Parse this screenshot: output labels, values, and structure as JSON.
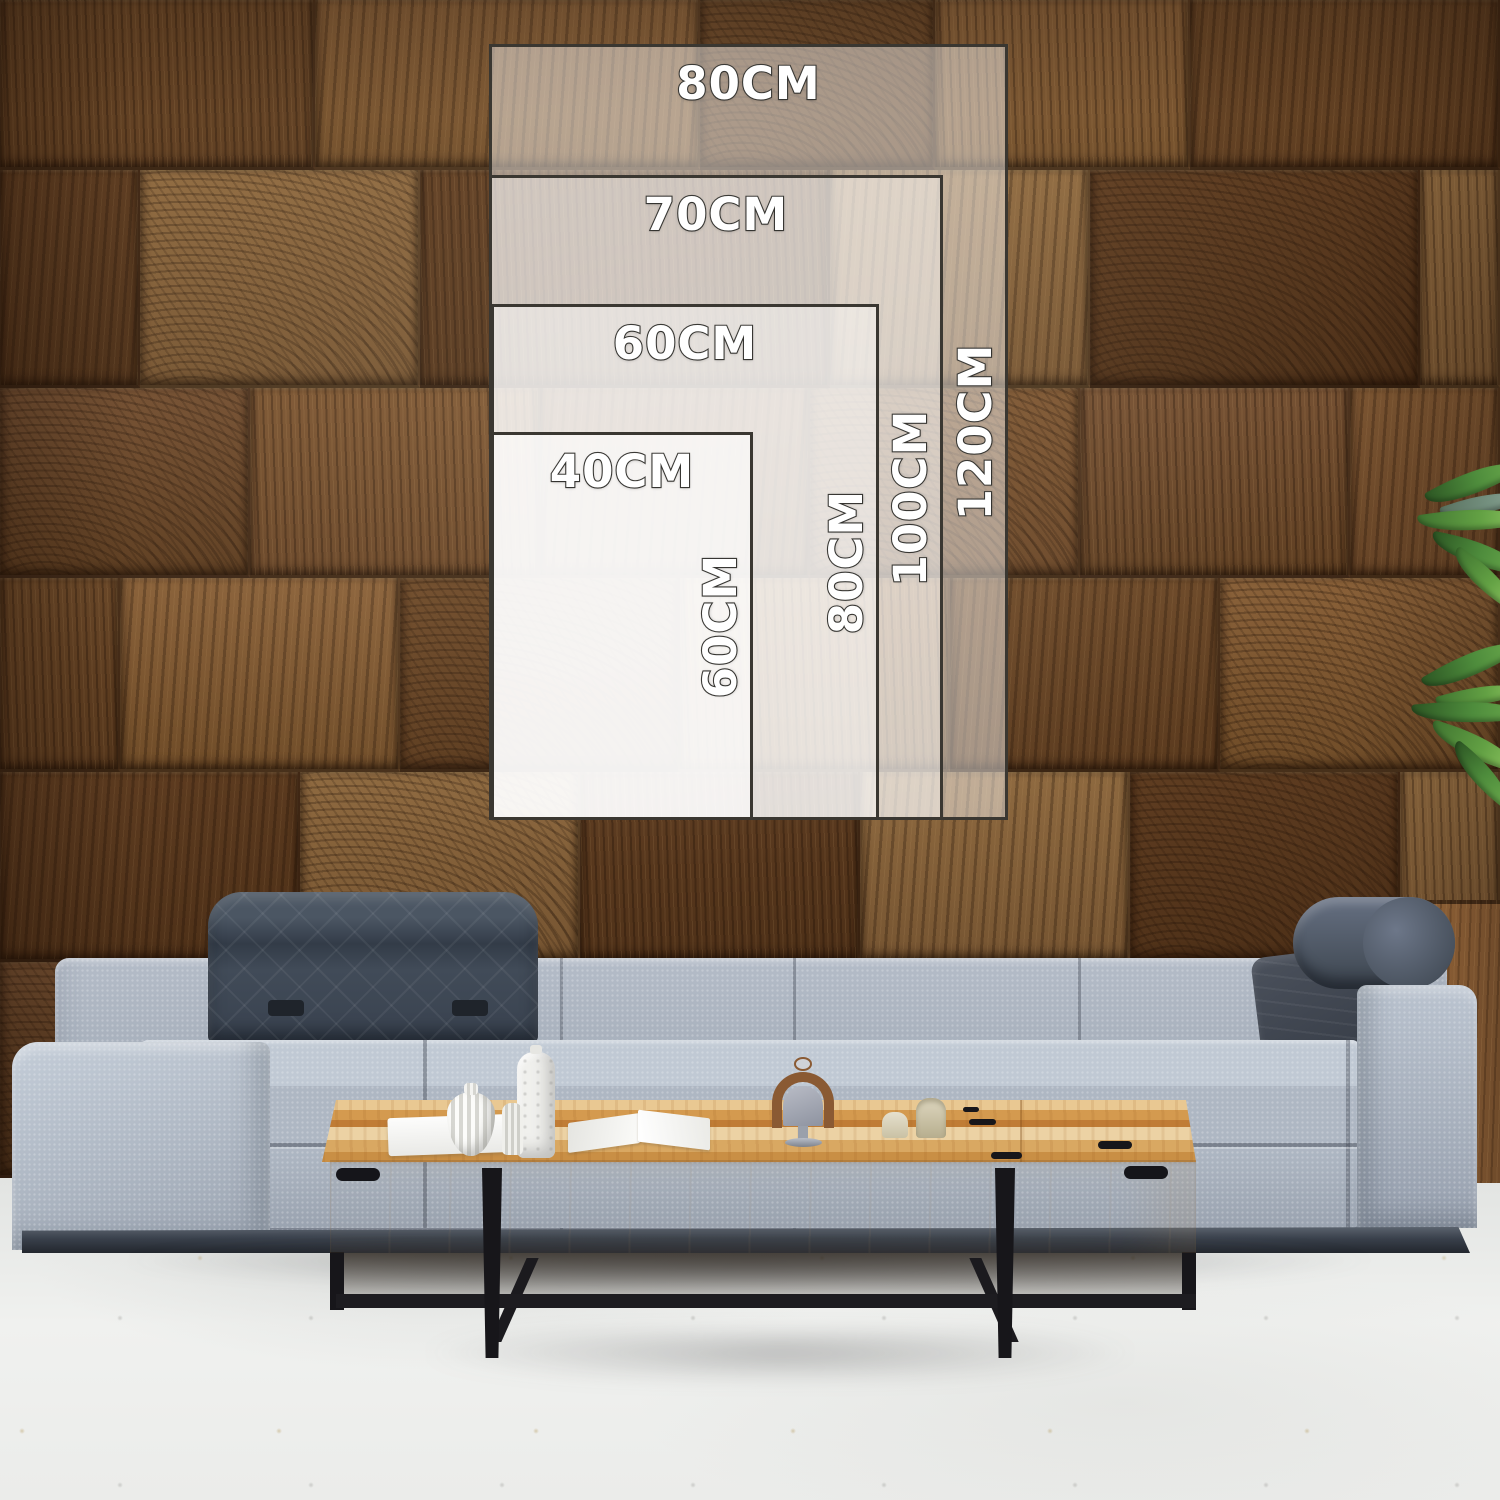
{
  "size_guide": {
    "sizes": [
      {
        "name": "80x120cm",
        "width_label": "80CM",
        "height_label": "120CM"
      },
      {
        "name": "70x100cm",
        "width_label": "70CM",
        "height_label": "100CM"
      },
      {
        "name": "60x80cm",
        "width_label": "60CM",
        "height_label": "80CM"
      },
      {
        "name": "40x60cm",
        "width_label": "40CM",
        "height_label": "60CM"
      }
    ]
  },
  "colors": {
    "overlay_fill": "rgba(255,255,255,0.45)",
    "overlay_border": "#3a3731",
    "label_text": "#ffffff",
    "label_outline": "#3e3d39",
    "wood_wall_base": "#6b4728",
    "sofa_fabric": "#a9b2bf",
    "headrest_fabric": "#3d4550",
    "table_top_wood": "#d9a258",
    "table_front_wood": "#f0e7d4",
    "table_legs_metal": "#17161a",
    "floor": "#eceeec",
    "plant_leaf_green": "#4e8c3c"
  }
}
